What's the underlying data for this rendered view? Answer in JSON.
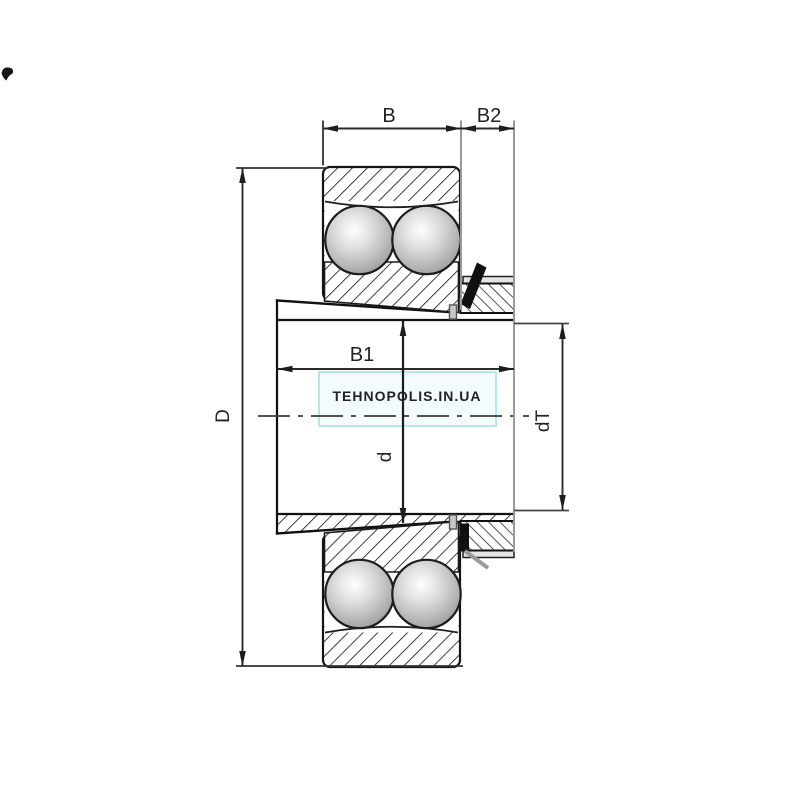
{
  "labels": {
    "b": "B",
    "b2": "B2",
    "b1": "B1",
    "D": "D",
    "d": "d",
    "dT": "dT"
  },
  "watermark": {
    "text": "TEHNOPOLIS.IN.UA",
    "text_color": "#e7f09c",
    "fill_color": "#f4fbfd",
    "border_color": "#b9e6ee"
  },
  "colors": {
    "outline": "#1a1a1a",
    "dimension_line": "#333333",
    "extension_gray": "#999999",
    "ball_shade": "#8c8c8c",
    "background": "#ffffff"
  }
}
